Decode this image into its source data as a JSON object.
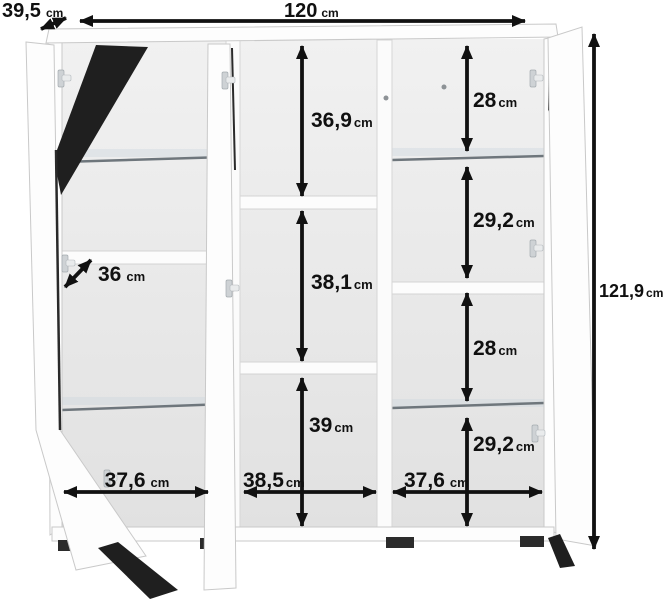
{
  "diagram": {
    "type": "furniture-dimension-diagram",
    "subject": "three-door display cabinet with open doors and measurement arrows",
    "unit": "cm"
  },
  "dimensions": {
    "depth_total": {
      "value": "39,5",
      "unit": "cm"
    },
    "width_total": {
      "value": "120",
      "unit": "cm"
    },
    "height_total": {
      "value": "121,9",
      "unit": "cm"
    },
    "shelf_depth": {
      "value": "36",
      "unit": "cm"
    },
    "center_top_height": {
      "value": "36,9",
      "unit": "cm"
    },
    "center_middle_height": {
      "value": "38,1",
      "unit": "cm"
    },
    "center_bottom_height": {
      "value": "39",
      "unit": "cm"
    },
    "right_section1_height": {
      "value": "28",
      "unit": "cm"
    },
    "right_section2_height": {
      "value": "29,2",
      "unit": "cm"
    },
    "right_section3_height": {
      "value": "28",
      "unit": "cm"
    },
    "right_section4_height": {
      "value": "29,2",
      "unit": "cm"
    },
    "left_inner_width": {
      "value": "37,6",
      "unit": "cm"
    },
    "center_inner_width": {
      "value": "38,5",
      "unit": "cm"
    },
    "right_inner_width": {
      "value": "37,6",
      "unit": "cm"
    }
  },
  "colors": {
    "background": "#ffffff",
    "annotation": "#111111",
    "panel": "#fdfdfd",
    "panel_edge": "#c9c9c9",
    "interior_top": "#f0f0f0",
    "interior_bottom": "#e1e1e1",
    "glass_shelf": "#6e767c",
    "door_gap": "#1f1f1f",
    "feet": "#2b2b2b"
  }
}
